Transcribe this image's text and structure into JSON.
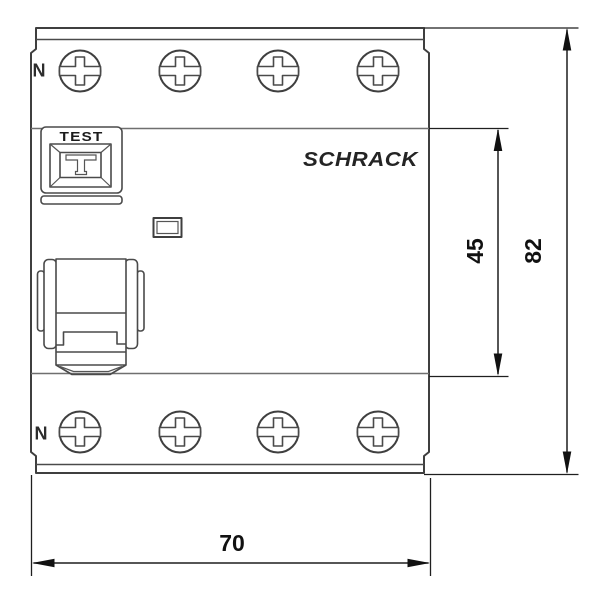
{
  "drawing": {
    "type": "dimensional front view of 4-pole residual current circuit breaker",
    "brand": "SCHRACK",
    "test_button_label": "TEST",
    "neutral_label_top": "N",
    "neutral_label_bottom": "N"
  },
  "dimensions": {
    "inner_height_mm": "45",
    "total_height_mm": "82",
    "total_width_mm": "70"
  },
  "colors": {
    "background": "#ffffff",
    "outline": "#3f3f3f",
    "dimension_lines": "#1f1f1f",
    "text": "#111111"
  }
}
